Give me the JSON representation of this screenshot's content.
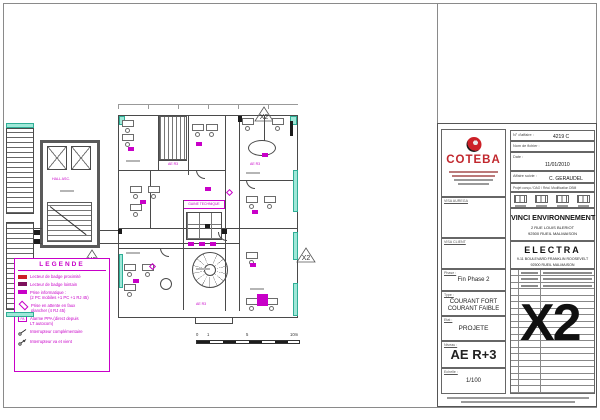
{
  "colors": {
    "magenta": "#c800c8",
    "brand_red": "#c1272d",
    "cyan_fill": "#9fe8d8",
    "cyan_border": "#2fae96",
    "line": "#4a4a4a"
  },
  "legend": {
    "title": "LEGENDE",
    "items": [
      {
        "text": "Lecteur de badge proximité"
      },
      {
        "text": "Lecteur de badge lointain"
      },
      {
        "text": "Prise informatique :",
        "text2": "(2 PC mobiles +1 PC +1 RJ 45)"
      },
      {
        "text": "Prise en attente en faux",
        "text2": "plancher (4 RJ 45)"
      },
      {
        "glyph": "PA",
        "text": "Alarme PPA (direct depuis",
        "text2": "LT autocom)"
      },
      {
        "text": "Interrupteur complémentaire"
      },
      {
        "text": "Interrupteur va et vient"
      }
    ]
  },
  "plan": {
    "labels": {
      "gaine": "GAINE TECHNIQUE",
      "hall": "HALL ASC."
    },
    "tags": [
      "AE R3",
      "AE R3",
      "AE R3"
    ],
    "annotations": [
      "X2",
      "X2",
      "X2"
    ],
    "scale": {
      "l0": "0",
      "l1": "1",
      "l5": "5",
      "l10": "10m"
    }
  },
  "title_block": {
    "company": "COTEBA",
    "fields": {
      "affaire_label": "N° d'affaire :",
      "affaire_value": "4219 C",
      "fichier_label": "Nom de fichier :",
      "fichier_value": "",
      "date_label": "Date :",
      "date_value": "11/01/2010",
      "suivie_label": "Affaire suivie :",
      "suivie_value": "C. GERAUDEL",
      "stamps_header": "Projet conçu / DAO / Réal. Modification DBM"
    },
    "visa1": "VISA AUREGA",
    "visa2": "VISA CLIENT",
    "client_name": "VINCI ENVIRONNEMENT",
    "client_addr1": "2 RUE LOUIS BLERIOT",
    "client_addr2": "92500 RUEIL MALMAISON",
    "project_name": "ELECTRA",
    "project_addr1": "9-11 BOULEVARD FRANKLIN ROOSEVELT",
    "project_addr2": "92500 RUEIL MALMAISON",
    "phase_label": "Phase :",
    "phase_value": "Fin Phase 2",
    "type_label": "Type :",
    "type_value1": "COURANT FORT",
    "type_value2": "COURANT FAIBLE",
    "etat_label": "Etat :",
    "etat_value": "PROJETE",
    "niveau_label": "Niveau :",
    "niveau_value": "AE R+3",
    "echelle_label": "Echelle :",
    "echelle_value": "1/100",
    "index_code": "X2"
  }
}
